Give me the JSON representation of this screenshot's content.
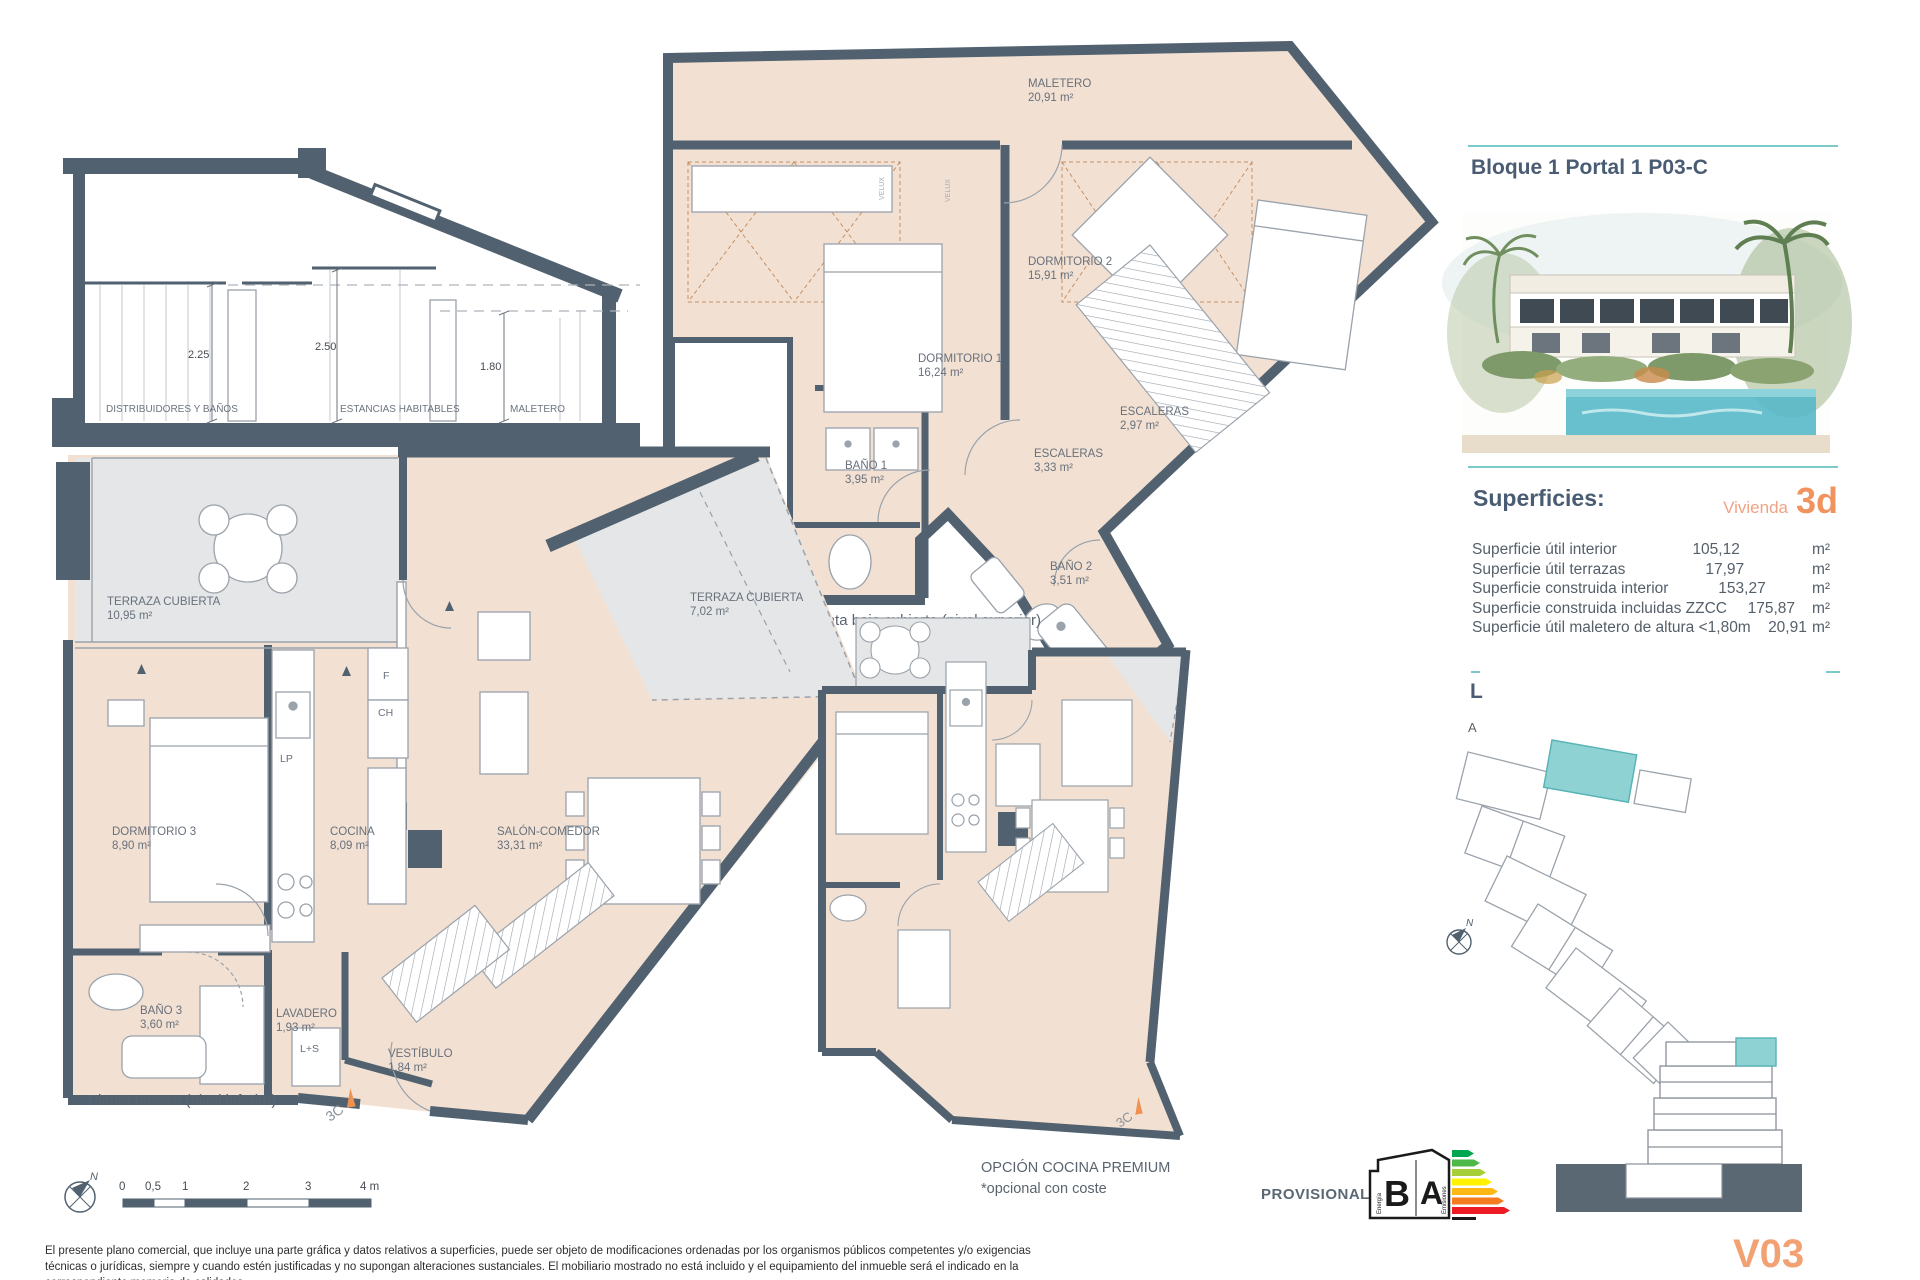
{
  "colors": {
    "wall": "#51616f",
    "floor": "#f2e1d3",
    "terrace": "#e4e6e7",
    "accent_teal": "#7cc9c9",
    "accent_orange": "#f0935e",
    "title_text": "#4a5c73"
  },
  "header": {
    "title": "Bloque 1 Portal 1 P03-C"
  },
  "superficies": {
    "heading": "Superficies:",
    "vivienda_label": "Vivienda",
    "vivienda_code": "3d",
    "rows": [
      {
        "label": "Superficie útil interior",
        "value": "105,12",
        "unit": "m²"
      },
      {
        "label": "Superficie útil terrazas",
        "value": "17,97",
        "unit": "m²"
      },
      {
        "label": "Superficie construida interior",
        "value": "153,27",
        "unit": "m²"
      },
      {
        "label": "Superficie construida incluidas ZZCC",
        "value": "175,87",
        "unit": "m²"
      },
      {
        "label": "Superficie útil maletero de altura <1,80m",
        "value": "20,91",
        "unit": "m²"
      }
    ]
  },
  "clipped": {
    "line_l": "L",
    "line_a": "A"
  },
  "section": {
    "caption": "Esquema de sección en planta ático",
    "dim_left": "2.25",
    "dim_mid": "2.50",
    "dim_right": "1.80",
    "zone_left": "DISTRIBUIDORES Y BAÑOS",
    "zone_mid": "ESTANCIAS HABITABLES",
    "zone_right": "MALETERO"
  },
  "plan_upper": {
    "caption": "Planta bajo cubierta (nivel superior)",
    "velux": "VELUX",
    "rooms": {
      "maletero": {
        "name": "MALETERO",
        "area": "20,91 m²"
      },
      "dormitorio2": {
        "name": "DORMITORIO 2",
        "area": "15,91 m²"
      },
      "dormitorio1": {
        "name": "DORMITORIO 1",
        "area": "16,24 m²"
      },
      "bano1": {
        "name": "BAÑO 1",
        "area": "3,95 m²"
      },
      "escaleras_a": {
        "name": "ESCALERAS",
        "area": "3,33 m²"
      },
      "escaleras_b": {
        "name": "ESCALERAS",
        "area": "2,97 m²"
      },
      "bano2": {
        "name": "BAÑO 2",
        "area": "3,51 m²"
      }
    }
  },
  "plan_lower": {
    "caption": "Planta tercera (nivel inferior)",
    "marker": "3C",
    "appliances": {
      "f": "F",
      "ch": "CH",
      "lp": "LP",
      "ls": "L+S"
    },
    "rooms": {
      "terraza1": {
        "name": "TERRAZA CUBIERTA",
        "area": "10,95 m²"
      },
      "dormitorio3": {
        "name": "DORMITORIO 3",
        "area": "8,90 m²"
      },
      "cocina": {
        "name": "COCINA",
        "area": "8,09 m²"
      },
      "salon": {
        "name": "SALÓN-COMEDOR",
        "area": "33,31 m²"
      },
      "terraza2": {
        "name": "TERRAZA CUBIERTA",
        "area": "7,02 m²"
      },
      "bano3": {
        "name": "BAÑO 3",
        "area": "3,60 m²"
      },
      "lavadero": {
        "name": "LAVADERO",
        "area": "1,93 m²"
      },
      "vestibulo": {
        "name": "VESTÍBULO",
        "area": "1,84 m²"
      }
    }
  },
  "plan_premium": {
    "caption": "OPCIÓN COCINA PREMIUM",
    "note": "*opcional con coste",
    "marker": "3C"
  },
  "scalebar": {
    "ticks": [
      "0",
      "0,5",
      "1",
      "2",
      "3",
      "4 m"
    ]
  },
  "compass_label": "N",
  "energy": {
    "provisional": "PROVISIONAL",
    "letter_consumo": "B",
    "letter_emisiones": "A",
    "axis_consumo": "Energía",
    "axis_emisiones": "Emisiones",
    "bar_colors": [
      "#00a650",
      "#4db848",
      "#a6ce39",
      "#fff200",
      "#fdb813",
      "#f47b20",
      "#ed1c24"
    ]
  },
  "footer": {
    "disclaimer": "El presente plano comercial, que incluye una parte gráfica y datos relativos a superficies, puede ser objeto de modificaciones ordenadas por los organismos públicos competentes y/o exigencias técnicas o jurídicas, siempre y cuando estén justificadas y no supongan alteraciones sustanciales. El mobiliario mostrado no está incluido y el equipamiento del inmueble será el indicado en la correspondiente memoria de calidades.",
    "version": "V03"
  }
}
